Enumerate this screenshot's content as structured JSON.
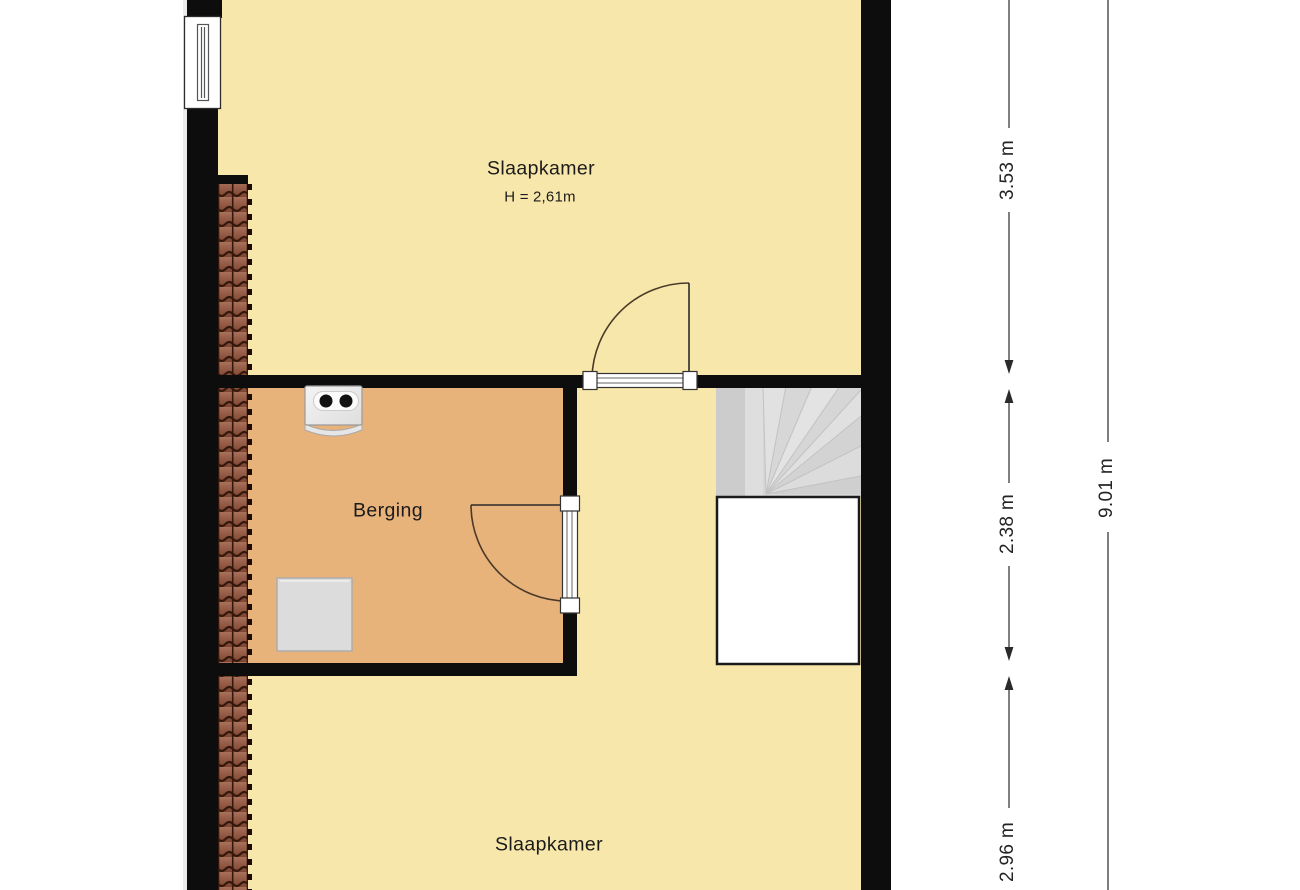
{
  "plan": {
    "rooms": {
      "bedroom_top": {
        "label": "Slaapkamer",
        "height_note": "H = 2,61m"
      },
      "storage": {
        "label": "Berging"
      },
      "bedroom_bottom": {
        "label": "Slaapkamer"
      }
    },
    "dimensions": {
      "segment_top": "3.53 m",
      "segment_middle": "2.38 m",
      "segment_bottom": "2.96 m",
      "total": "9.01 m"
    },
    "icons": [
      "window-icon",
      "roof-tile-hatch-icon",
      "door-swing-icon",
      "winder-stairs-icon",
      "stairwell-void",
      "boiler-icon",
      "washer-icon",
      "dimension-arrow-icon"
    ],
    "colors": {
      "room_fill": "#f8e7ab",
      "storage_fill": "#e8b27b",
      "wall": "#0d0d0d",
      "stairs_fill": "#d8d8d8",
      "tile_fill": "#9c6450",
      "tile_outline": "#35180c",
      "door_arc": "#4a3a28",
      "dimension": "#2a2a2a",
      "fixture_fill": "#eeeeee"
    }
  }
}
